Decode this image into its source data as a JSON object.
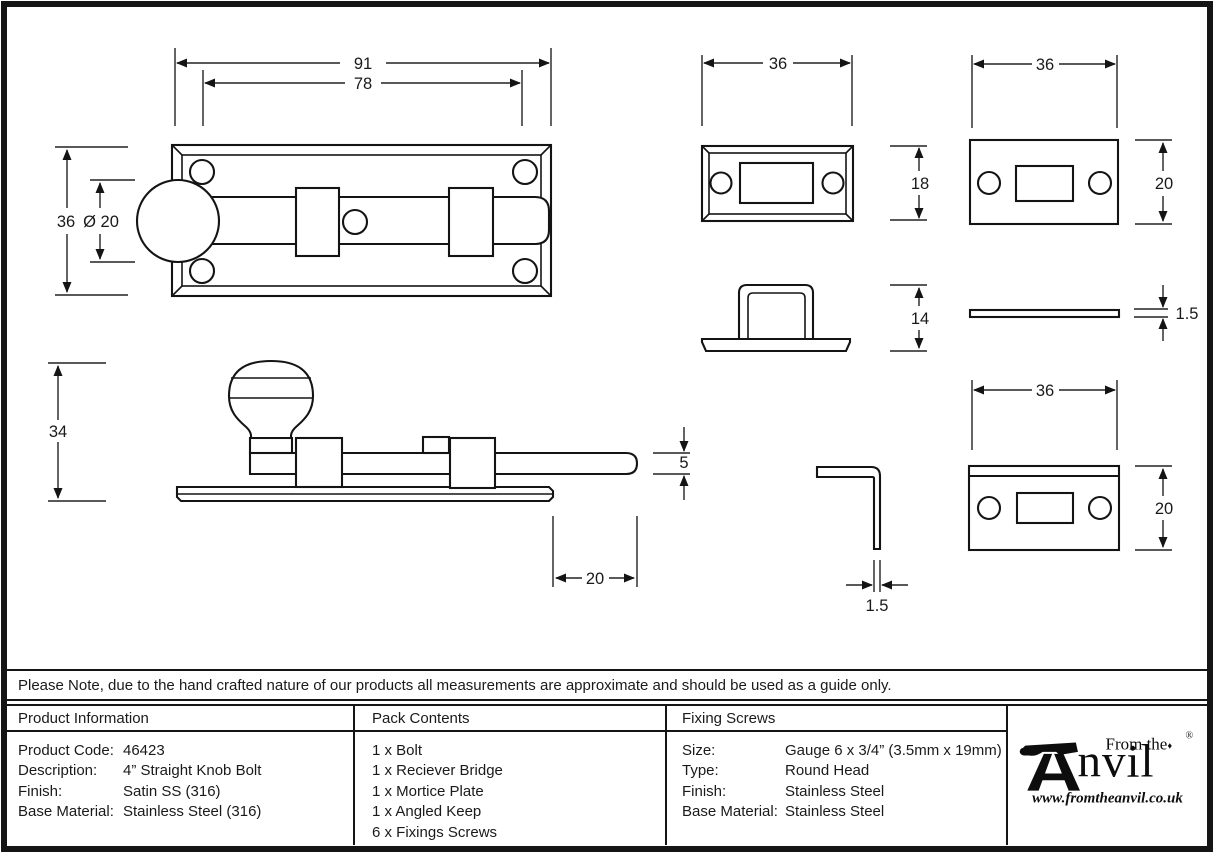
{
  "note": {
    "text": "Please Note, due to the hand crafted nature of our products all measurements are approximate and should be used as a guide only."
  },
  "table": {
    "product_information": {
      "header": "Product Information",
      "rows": [
        {
          "label": "Product Code:",
          "value": "46423"
        },
        {
          "label": "Description:",
          "value": "4” Straight Knob Bolt"
        },
        {
          "label": "Finish:",
          "value": "Satin SS (316)"
        },
        {
          "label": "Base Material:",
          "value": "Stainless Steel (316)"
        }
      ]
    },
    "pack_contents": {
      "header": "Pack Contents",
      "items": [
        "1 x Bolt",
        "1 x Reciever Bridge",
        "1 x Mortice Plate",
        "1 x Angled Keep",
        "6 x Fixings Screws"
      ]
    },
    "fixing_screws": {
      "header": "Fixing Screws",
      "rows": [
        {
          "label": "Size:",
          "value": "Gauge 6 x 3/4” (3.5mm x 19mm)"
        },
        {
          "label": "Type:",
          "value": "Round Head"
        },
        {
          "label": "Finish:",
          "value": "Stainless Steel"
        },
        {
          "label": "Base Material:",
          "value": "Stainless Steel"
        }
      ]
    }
  },
  "logo": {
    "tagline": "From the",
    "diamond": "♦",
    "brand_suffix": "nvil",
    "registered": "®",
    "url": "www.fromtheanvil.co.uk"
  },
  "dims": {
    "plan": {
      "overall": "91",
      "inner": "78",
      "height": "36",
      "knob": "Ø 20"
    },
    "side": {
      "height": "34",
      "rod": "5",
      "throw": "20"
    },
    "bridge_front": {
      "width": "36",
      "height": "18"
    },
    "bridge_side": {
      "height": "14"
    },
    "keep_side": {
      "thickness": "1.5"
    },
    "mortice": {
      "width": "36",
      "height": "20"
    },
    "mortice_side": {
      "thickness": "1.5"
    },
    "keep_front": {
      "width": "36",
      "height": "20"
    }
  }
}
